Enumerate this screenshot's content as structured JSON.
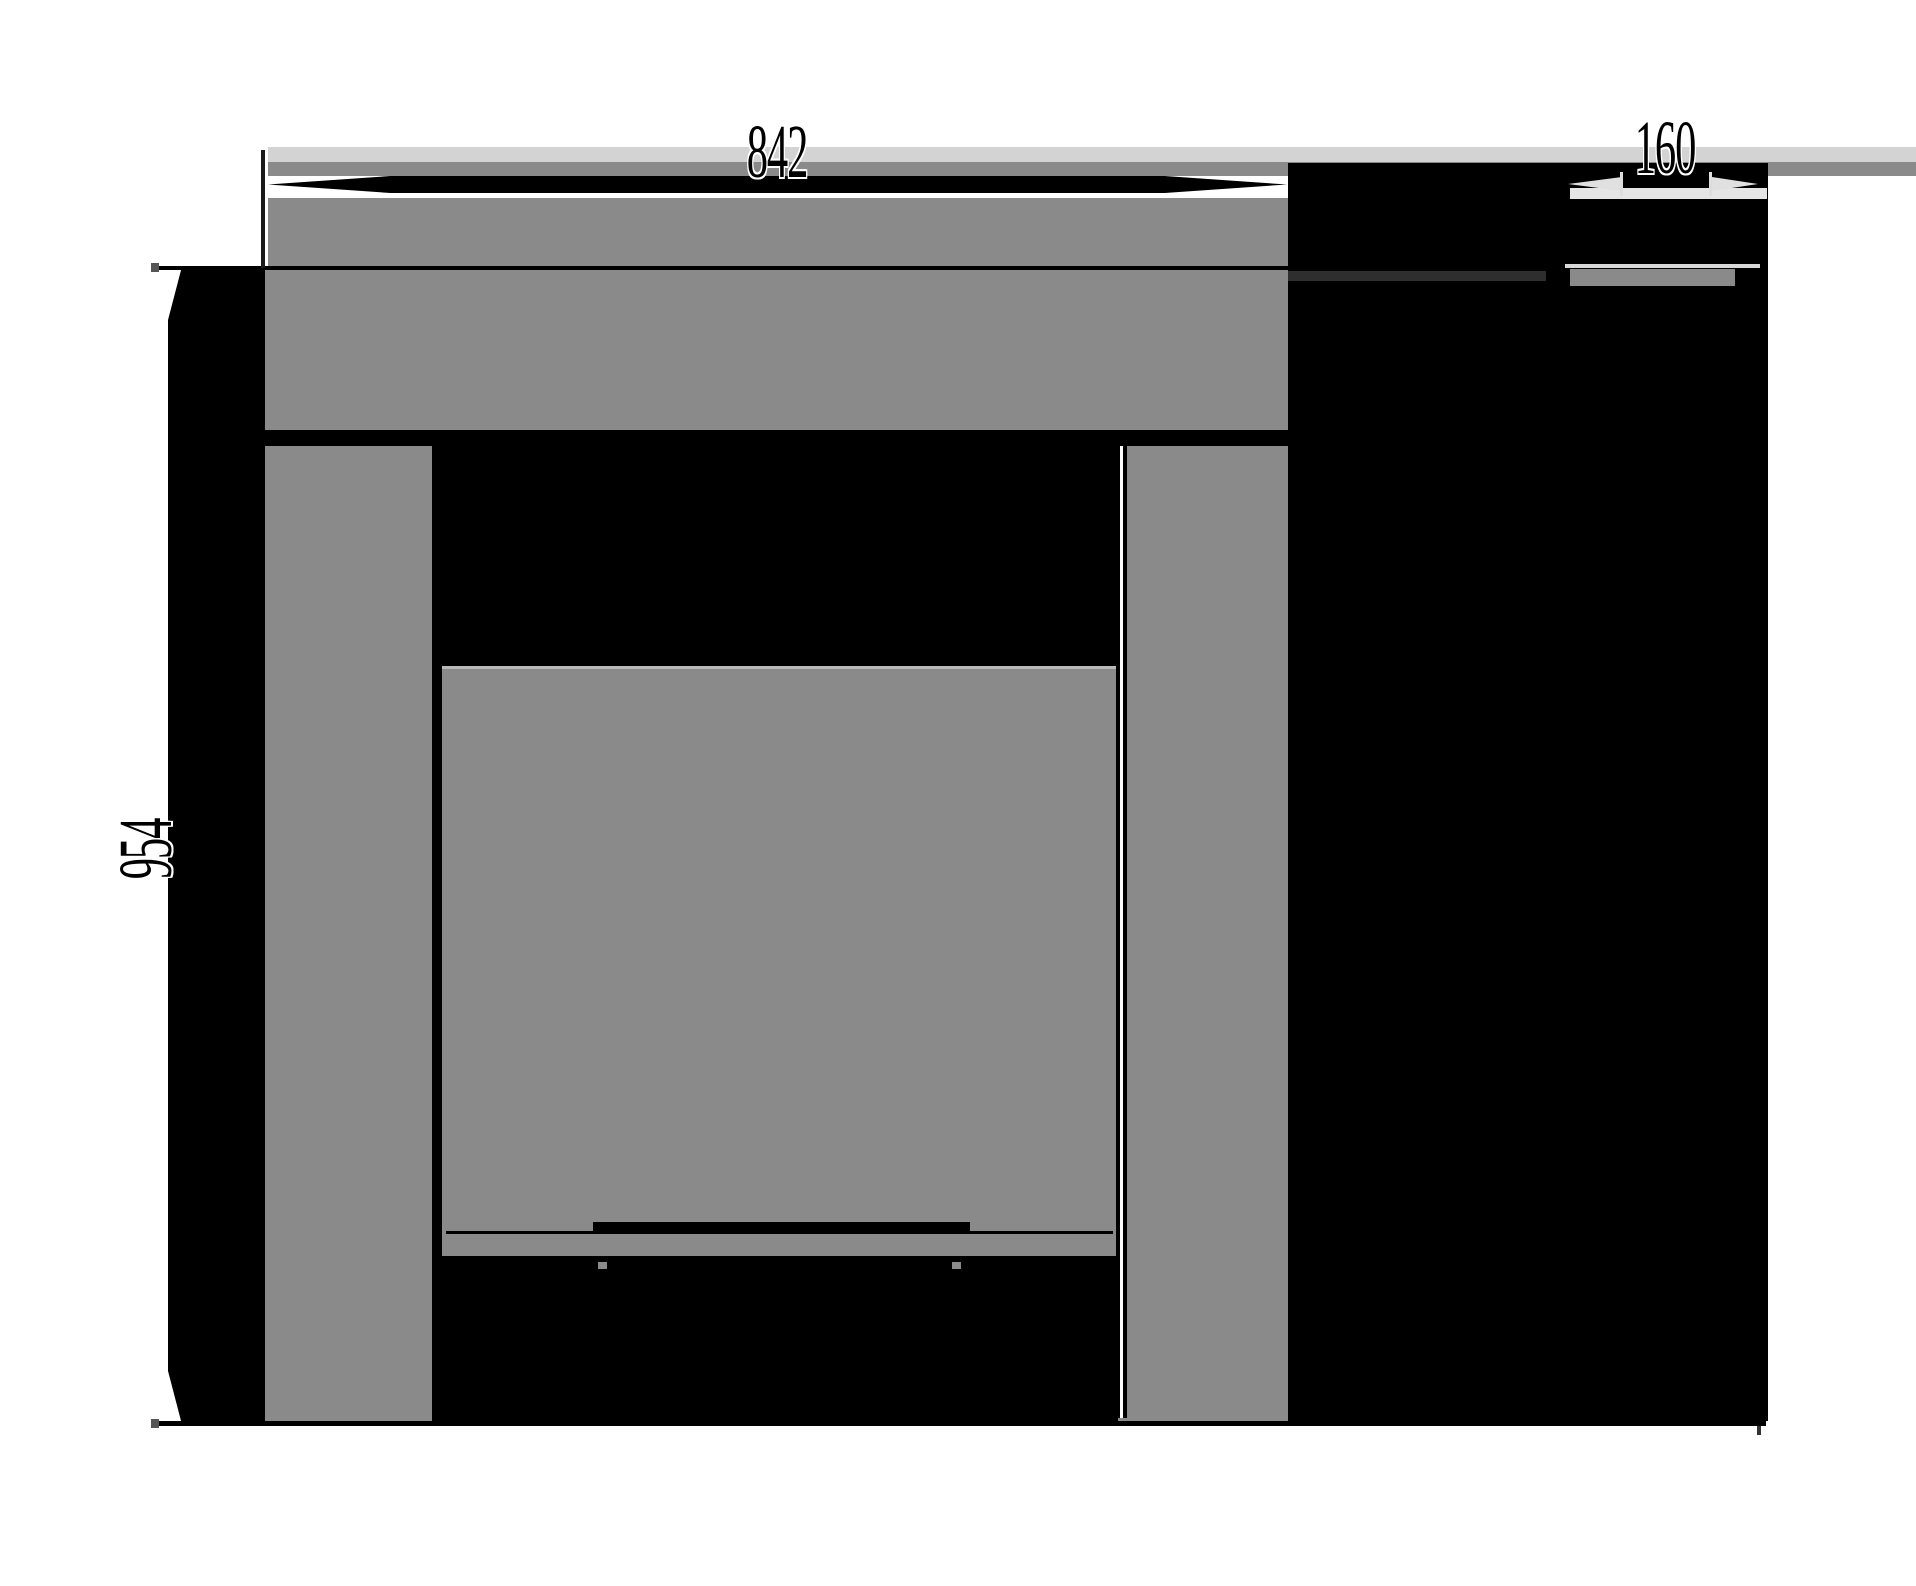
{
  "drawing": {
    "type": "technical-dimension-drawing",
    "views": {
      "front": "front-elevation",
      "side": "side-elevation"
    },
    "dimensions": {
      "width": {
        "label": "842",
        "orientation": "horizontal"
      },
      "depth": {
        "label": "160",
        "orientation": "horizontal"
      },
      "height": {
        "label": "954",
        "orientation": "vertical"
      }
    },
    "colors": {
      "background": "#ffffff",
      "fill_gray": "#8a8a8a",
      "fill_black": "#000000",
      "band_light": "#d3d3d3",
      "sliver_light": "#e5e5e5",
      "line_dark": "#1a1a1a"
    }
  }
}
